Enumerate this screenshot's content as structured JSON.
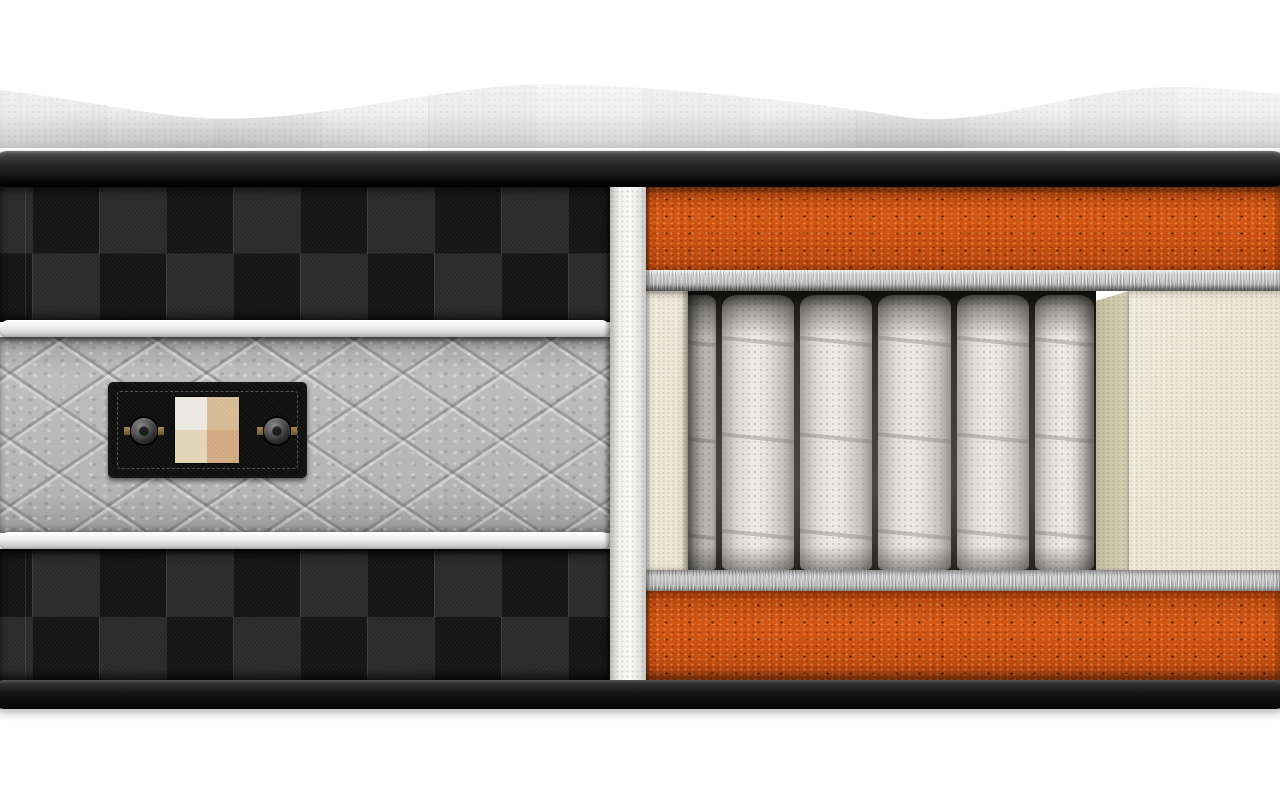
{
  "scene": {
    "type": "3d-product-render",
    "subject": "mattress cross-section cutaway showing internal construction layers",
    "background_color": "#ffffff",
    "canvas": {
      "width": 1280,
      "height": 800
    }
  },
  "top_panel": {
    "name": "quilted pillow-top surface",
    "fabric_color": "#f1f1f1",
    "valley_shadow_color": "#d9d9d9",
    "silhouette_points": [
      [
        0,
        90
      ],
      [
        187,
        117
      ],
      [
        520,
        85
      ],
      [
        903,
        117
      ],
      [
        1150,
        88
      ],
      [
        1280,
        94
      ]
    ],
    "patch_grid_px": {
      "width": 107,
      "height": 76
    }
  },
  "piping_bands": {
    "top": {
      "highlight": "#4d4d4d",
      "base": "#0b0b0b",
      "height_px": 36
    },
    "bottom": {
      "highlight": "#3a3a3a",
      "base": "#050505",
      "height_px": 29
    }
  },
  "side_panel": {
    "checker_fabric": {
      "dark": "#141414",
      "light": "#2a2a2a",
      "cell_px": 67,
      "rows_per_band": 2
    },
    "piping_strip_color": "#f2f2f2",
    "piping_strip_count": 2,
    "quilted_band": {
      "base_color": "#b5b5b5",
      "pattern": "diamond quilting",
      "texture": "plush mottled gray"
    }
  },
  "label": {
    "background": "#0e0e0e",
    "stitch_border_color": "#56564c",
    "swatch_colors": {
      "top_left": "#eae7e0",
      "top_right": "#d5b992",
      "bottom_left": "#e2d4b4",
      "bottom_right": "#cfa87e"
    },
    "grommet_count": 2,
    "grommet_color": "#3f3f3f",
    "grommet_tab_color": "#8a6f35"
  },
  "cutaway": {
    "cut_edge_fabric_color": "#f3f3f1",
    "foam_color": "#cc5213",
    "foam_speckle_dark": "#7a2806",
    "foam_speckle_light": "#eda654",
    "felt_color": "#cbcbcb",
    "spring_fabric_color": "#e8e6e2",
    "cavity_shadow_color": "#2e2c27",
    "foam_encasement_color": "#ebe6d2",
    "foam_encasement_side_color": "#cfc9ae",
    "springs": {
      "visible": 6,
      "full": 5,
      "partial": 1,
      "width_px": 72
    },
    "layers_top_to_bottom": [
      {
        "name": "comfort foam top layer",
        "color": "#cc5213",
        "thickness_px": 85
      },
      {
        "name": "felt insulator pad",
        "color": "#cbcbcb",
        "thickness_px": 21
      },
      {
        "name": "pocket spring core in foam encasement",
        "color": "#e8e6e2",
        "thickness_px": 279
      },
      {
        "name": "felt insulator pad",
        "color": "#cbcbcb",
        "thickness_px": 21
      },
      {
        "name": "comfort foam bottom layer",
        "color": "#cc5213",
        "thickness_px": 90
      }
    ]
  }
}
